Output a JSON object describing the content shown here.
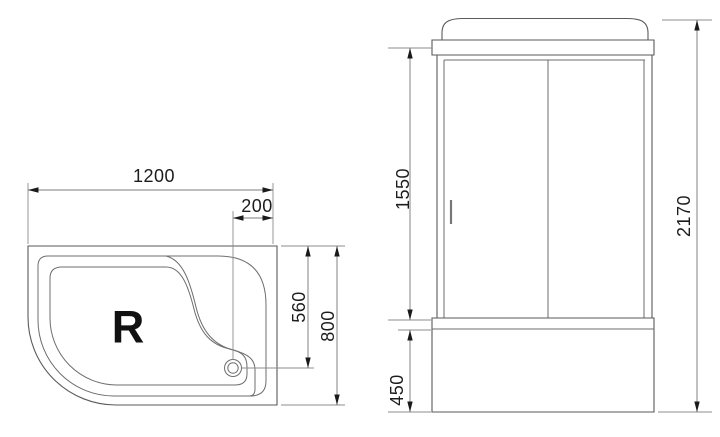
{
  "colors": {
    "background": "#ffffff",
    "outline": "#5a5a5a",
    "dimension_line": "#7d7d7d",
    "text": "#1c1c1c",
    "arrow": "#1a1a1a"
  },
  "top_view": {
    "orientation_label": "R",
    "dims": {
      "width": "1200",
      "drain_offset": "200",
      "drain_depth": "560",
      "depth": "800"
    }
  },
  "front_view": {
    "dims": {
      "glass_height": "1550",
      "base_height": "450",
      "total_height": "2170"
    }
  }
}
